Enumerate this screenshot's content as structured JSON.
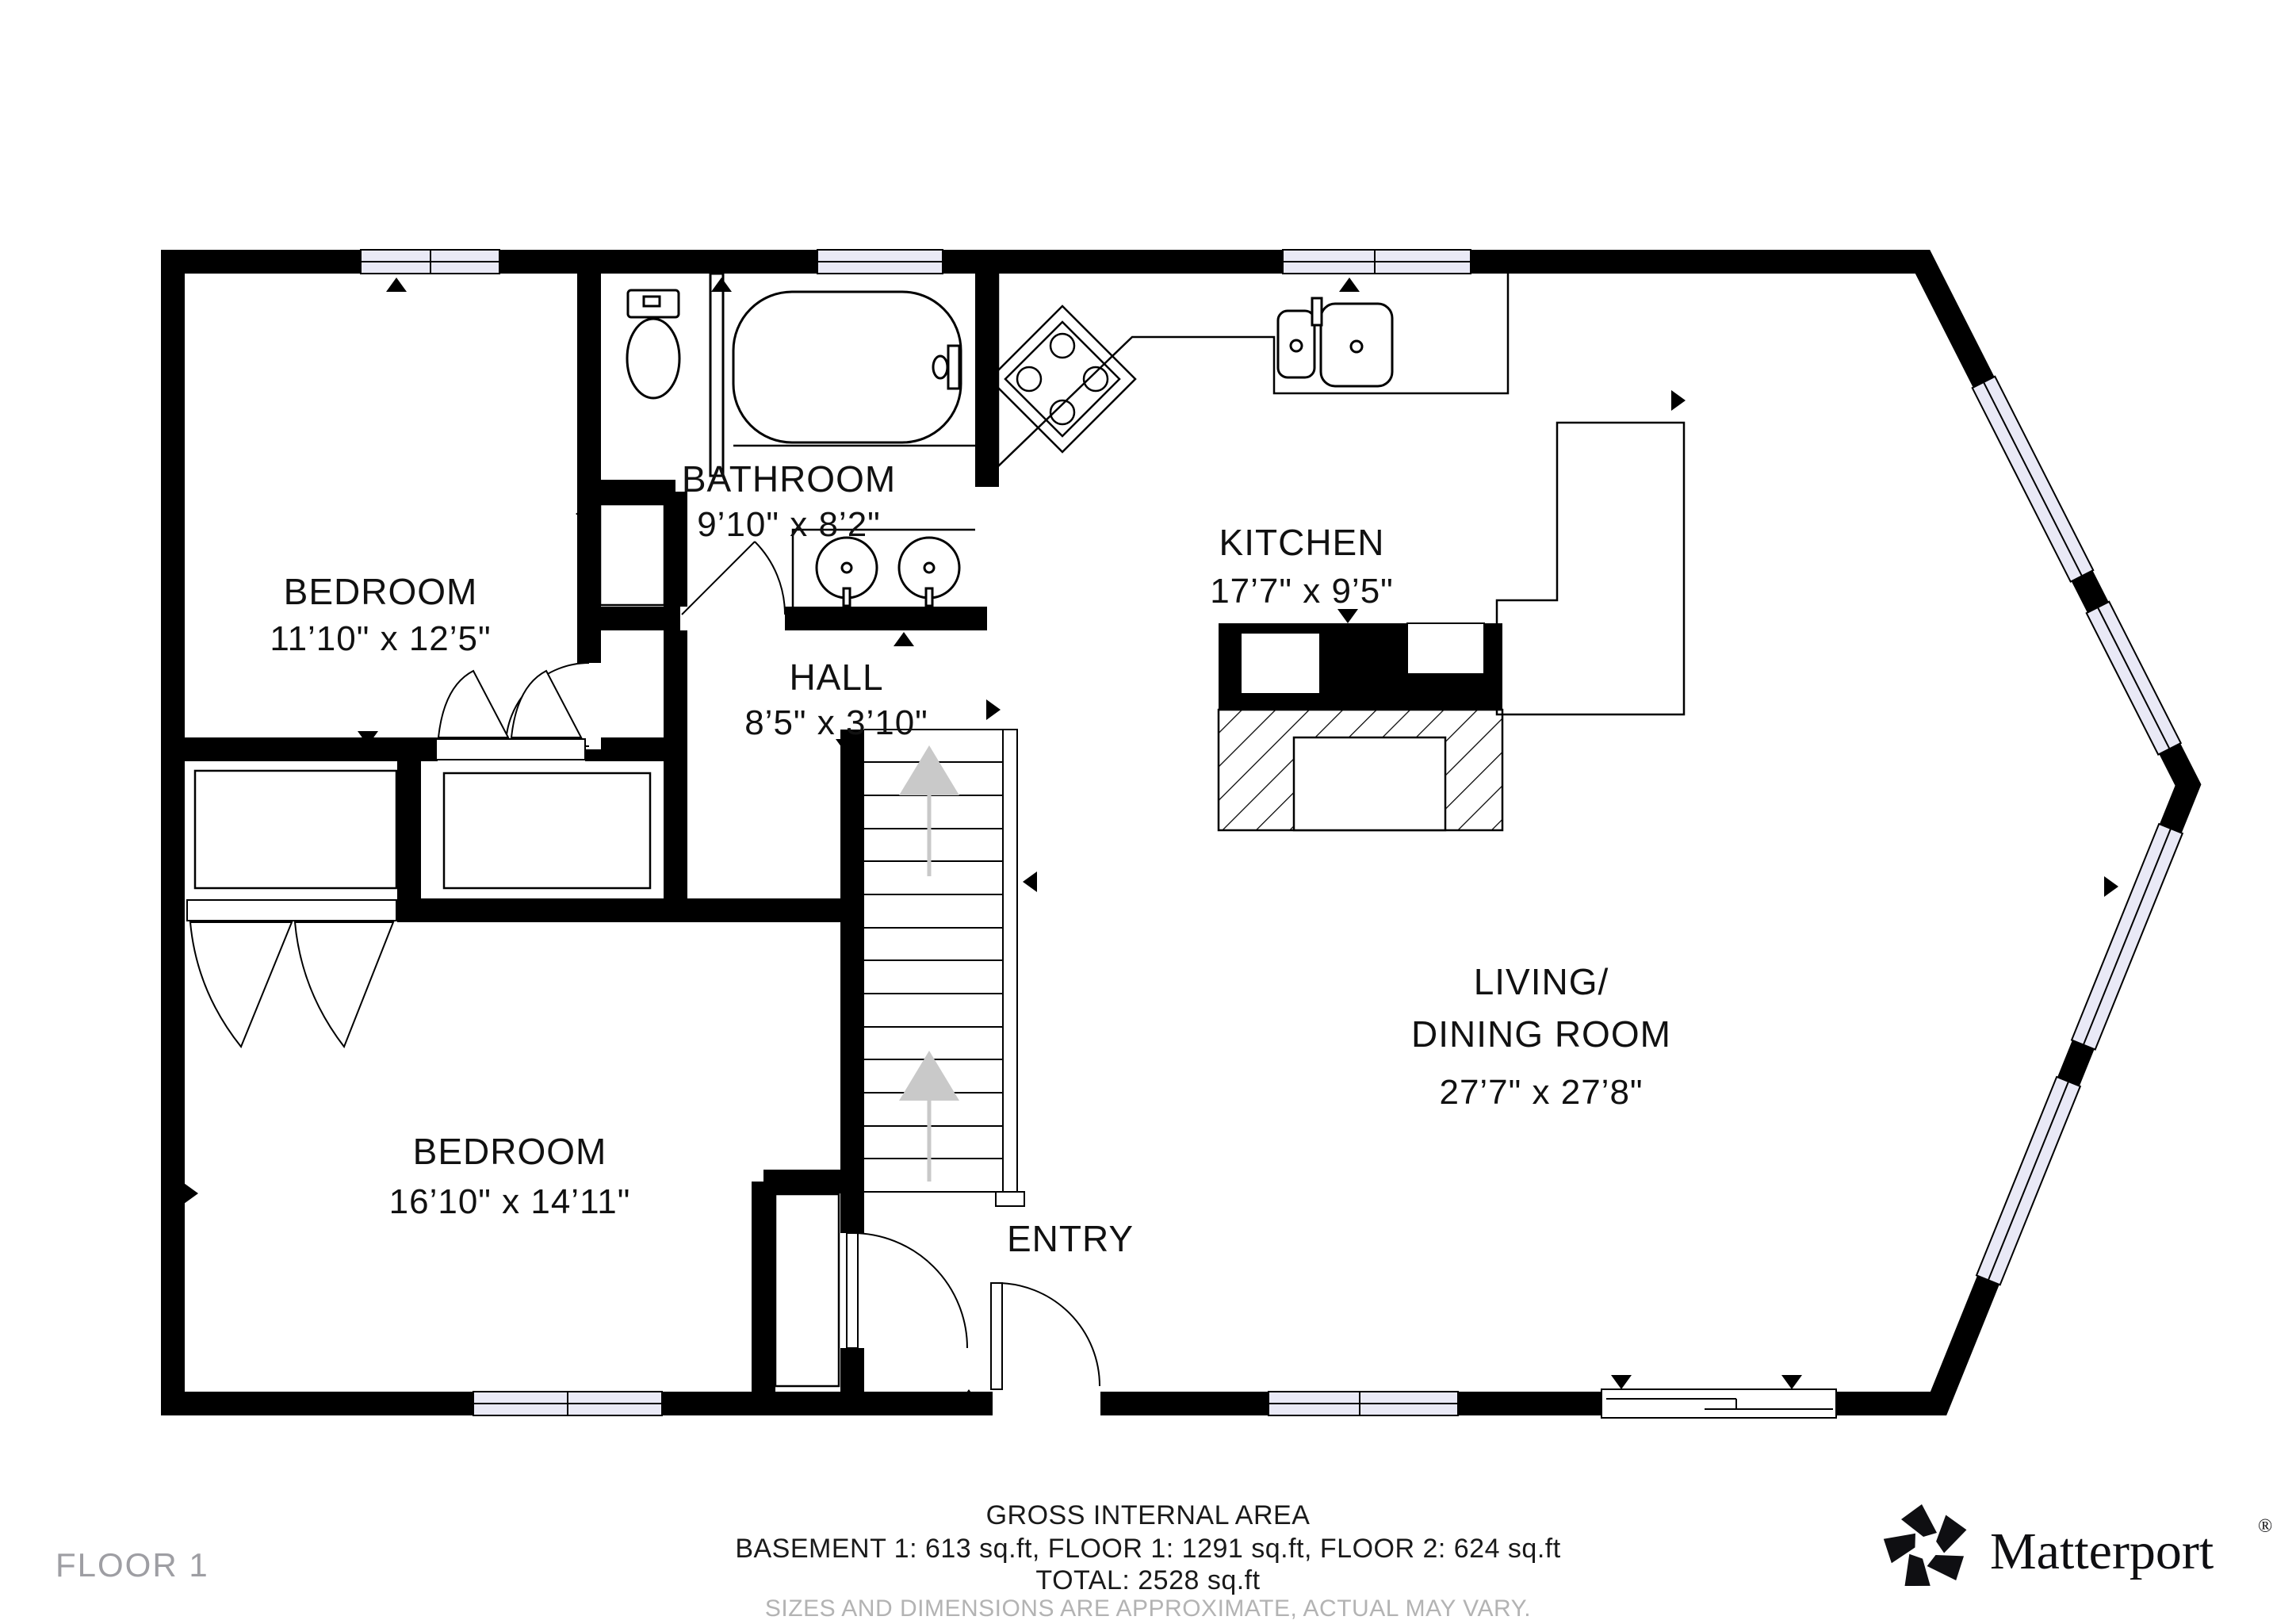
{
  "floor": {
    "label": "FLOOR 1"
  },
  "rooms": {
    "bedroom1": {
      "name": "BEDROOM",
      "dims": "11’10\" x 12’5\""
    },
    "bathroom": {
      "name": "BATHROOM",
      "dims": "9’10\" x 8’2\""
    },
    "hall": {
      "name": "HALL",
      "dims": "8’5\" x 3’10\""
    },
    "kitchen": {
      "name": "KITCHEN",
      "dims": "17’7\" x 9’5\""
    },
    "bedroom2": {
      "name": "BEDROOM",
      "dims": "16’10\" x 14’11\""
    },
    "living": {
      "name_line1": "LIVING/",
      "name_line2": "DINING ROOM",
      "dims": "27’7\" x 27’8\""
    },
    "entry": {
      "name": "ENTRY"
    }
  },
  "footer": {
    "title": "GROSS INTERNAL AREA",
    "breakdown": "BASEMENT 1: 613 sq.ft, FLOOR 1: 1291 sq.ft, FLOOR 2: 624 sq.ft",
    "total": "TOTAL: 2528 sq.ft",
    "disclaimer": "SIZES AND DIMENSIONS ARE APPROXIMATE, ACTUAL MAY VARY."
  },
  "brand": {
    "name": "Matterport",
    "registered": "®"
  },
  "colors": {
    "wall": "#000000",
    "window_fill": "#e9e9f6",
    "floor": "#ffffff",
    "stair_arrow": "#c9c9c9",
    "label": "#111111",
    "muted_text": "#9e9ea3"
  }
}
